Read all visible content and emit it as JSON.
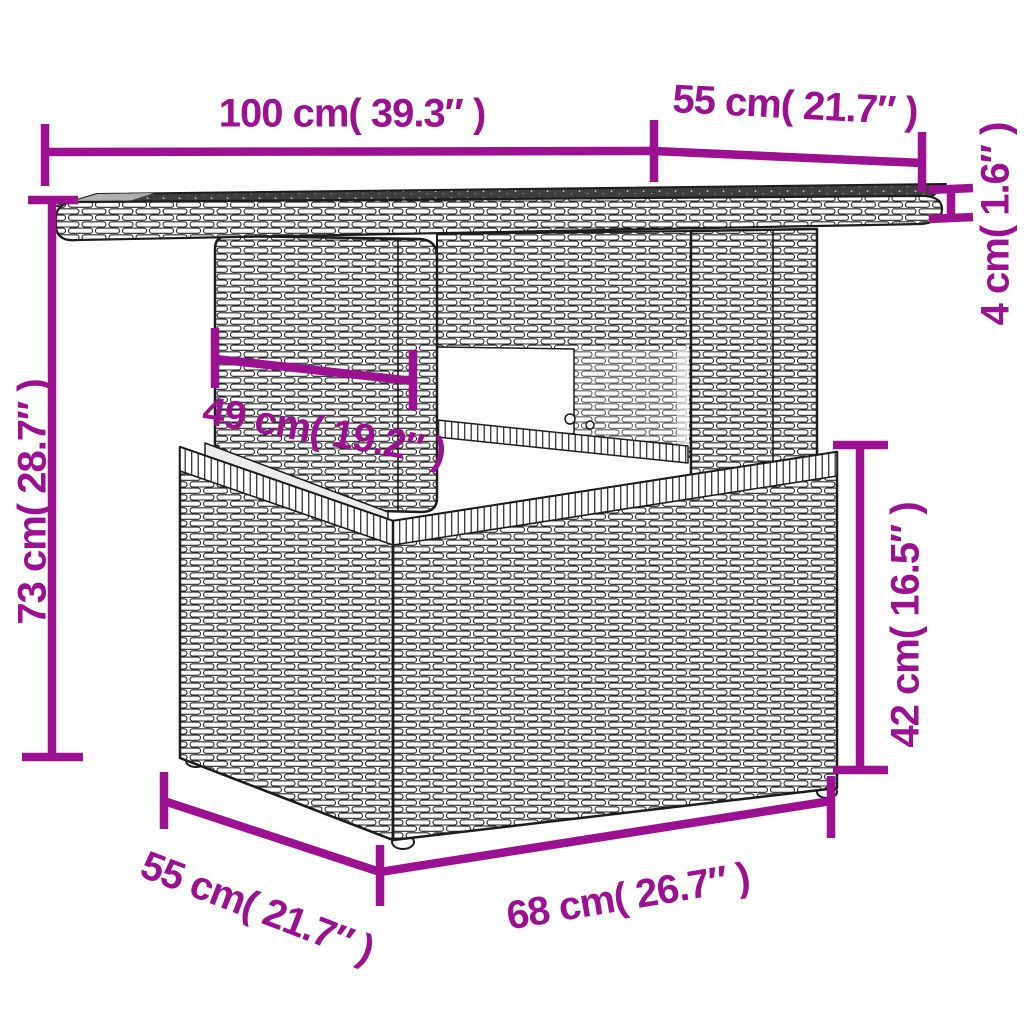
{
  "figure": {
    "kind": "product-dimension-diagram",
    "subject": "rattan-table-with-glass-top"
  },
  "colors": {
    "accent": "#9C1191",
    "outline": "#1c1c1c",
    "glass": "#3e3e3e",
    "background": "#ffffff"
  },
  "dimensions": {
    "tabletop_width": {
      "label": "100 cm( 39.3″ )",
      "cm": "100",
      "inches": "39.3"
    },
    "tabletop_depth": {
      "label": "55 cm( 21.7″ )",
      "cm": "55",
      "inches": "21.7"
    },
    "tabletop_thickness": {
      "label": "4 cm( 1.6″ )",
      "cm": "4",
      "inches": "1.6"
    },
    "total_height": {
      "label": "73 cm( 28.7″ )",
      "cm": "73",
      "inches": "28.7"
    },
    "pedestal_width": {
      "label": "49 cm( 19.2″ )",
      "cm": "49",
      "inches": "19.2"
    },
    "base_height": {
      "label": "42 cm( 16.5″ )",
      "cm": "42",
      "inches": "16.5"
    },
    "base_width": {
      "label": "68 cm( 26.7″ )",
      "cm": "68",
      "inches": "26.7"
    },
    "base_depth": {
      "label": "55 cm( 21.7″ )",
      "cm": "55",
      "inches": "21.7"
    }
  }
}
